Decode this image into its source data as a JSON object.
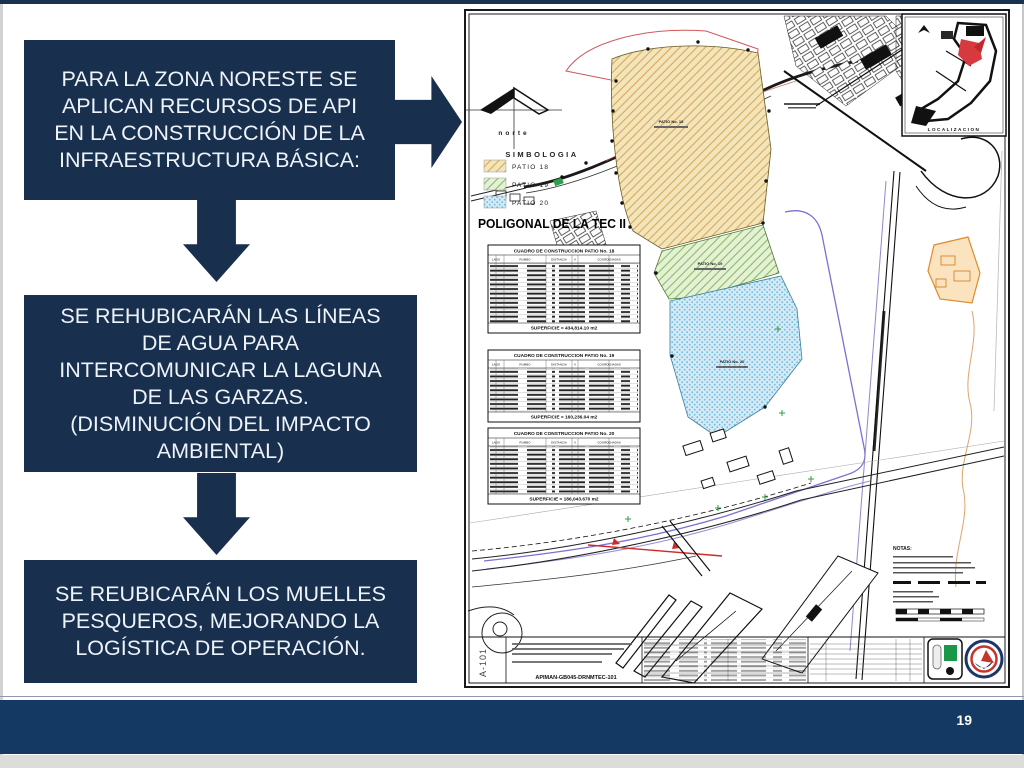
{
  "page": {
    "number": "19"
  },
  "colors": {
    "navy": "#182f4e",
    "bottom_bar": "#143a63",
    "patio18_fill": "#f3e5ba",
    "patio18_hatch": "#d8a75e",
    "patio19_fill": "#e5f1d5",
    "patio19_hatch": "#8abb68",
    "patio20_fill": "#d3eaf7",
    "patio20_hatch": "#74bad9",
    "water_line_purple": "#7e6fd0",
    "highlight_red": "#cc2b28",
    "highlight_orange": "#e08a28"
  },
  "flow": {
    "box1": "PARA LA ZONA NORESTE SE\nAPLICAN  RECURSOS DE API\nEN LA CONSTRUCCIÓN DE LA\nINFRAESTRUCTURA BÁSICA:",
    "box2": "SE REHUBICARÁN LAS LÍNEAS\nDE AGUA PARA\nINTERCOMUNICAR LA LAGUNA\nDE LAS GARZAS.\n(DISMINUCIÓN DEL IMPACTO\nAMBIENTAL)",
    "box3": "SE REUBICARÁN LOS MUELLES\nPESQUEROS, MEJORANDO LA\nLOGÍSTICA DE OPERACIÓN."
  },
  "map": {
    "north_label": "norte",
    "legend": {
      "title": "SIMBOLOGIA",
      "items": [
        {
          "label": "PATIO 18"
        },
        {
          "label": "PATIO 19"
        },
        {
          "label": "PATIO 20"
        }
      ]
    },
    "title": "POLIGONAL DE LA TEC II",
    "table_headers": [
      "LADO",
      "RUMBO",
      "DISTANCIA",
      "V",
      "COORDENADAS"
    ],
    "tables": [
      {
        "title": "CUADRO DE CONSTRUCCION PATIO No. 18",
        "footer": "SUPERFICIE = 434,814.10 m2"
      },
      {
        "title": "CUADRO DE CONSTRUCCION PATIO No. 19",
        "footer": "SUPERFICIE = 160,236.04 m2"
      },
      {
        "title": "CUADRO DE CONSTRUCCION PATIO No. 20",
        "footer": "SUPERFICIE = 186,043.670 m2"
      }
    ],
    "patio_labels": {
      "p18": "PATIO No. 18",
      "p19": "PATIO No. 19",
      "p20": "PATIO No. 20"
    },
    "inset": {
      "label": "LOCALIZACION"
    },
    "notes_title": "NOTAS:",
    "titleblock": {
      "sheet": "A-101",
      "code": "APIMAN-GB045-DRNMTEC-101"
    }
  }
}
